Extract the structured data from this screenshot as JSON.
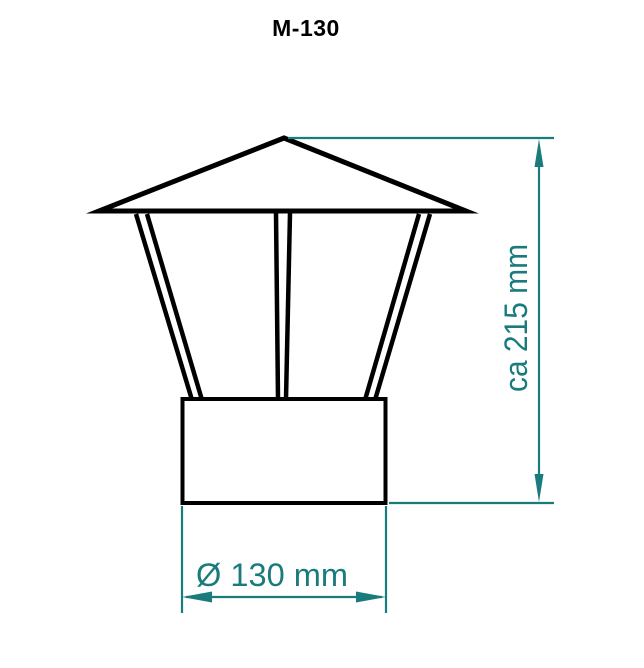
{
  "drawing": {
    "part_name": "M-130",
    "kind": "chimney-rain-cap-front-view",
    "dimensions": {
      "height": {
        "label": "ca 215 mm",
        "value": 215,
        "unit": "mm",
        "approximate": true
      },
      "diameter": {
        "label": "Ø 130 mm",
        "value": 130,
        "unit": "mm",
        "symbol": "Ø"
      }
    }
  },
  "colors": {
    "drawing_black": "#000000",
    "dimension_teal": "#1A7B7D",
    "background": "#FFFFFF"
  }
}
